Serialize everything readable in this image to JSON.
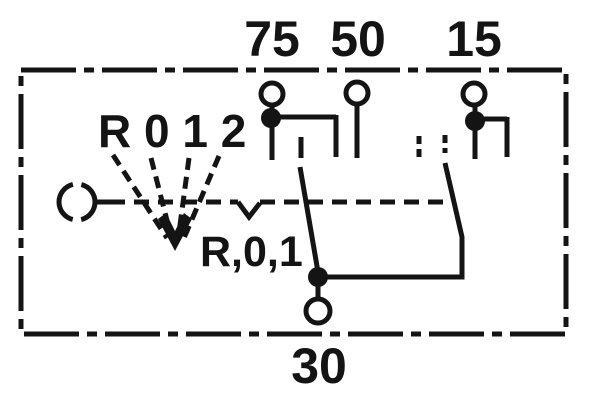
{
  "colors": {
    "ink": "#141414",
    "background": "#ffffff"
  },
  "diagram": {
    "terminal_labels": {
      "t75": "75",
      "t50": "50",
      "t15": "15",
      "t30": "30"
    },
    "positions_label": "R 0 1 2",
    "bridge_label": "R,0,1"
  }
}
